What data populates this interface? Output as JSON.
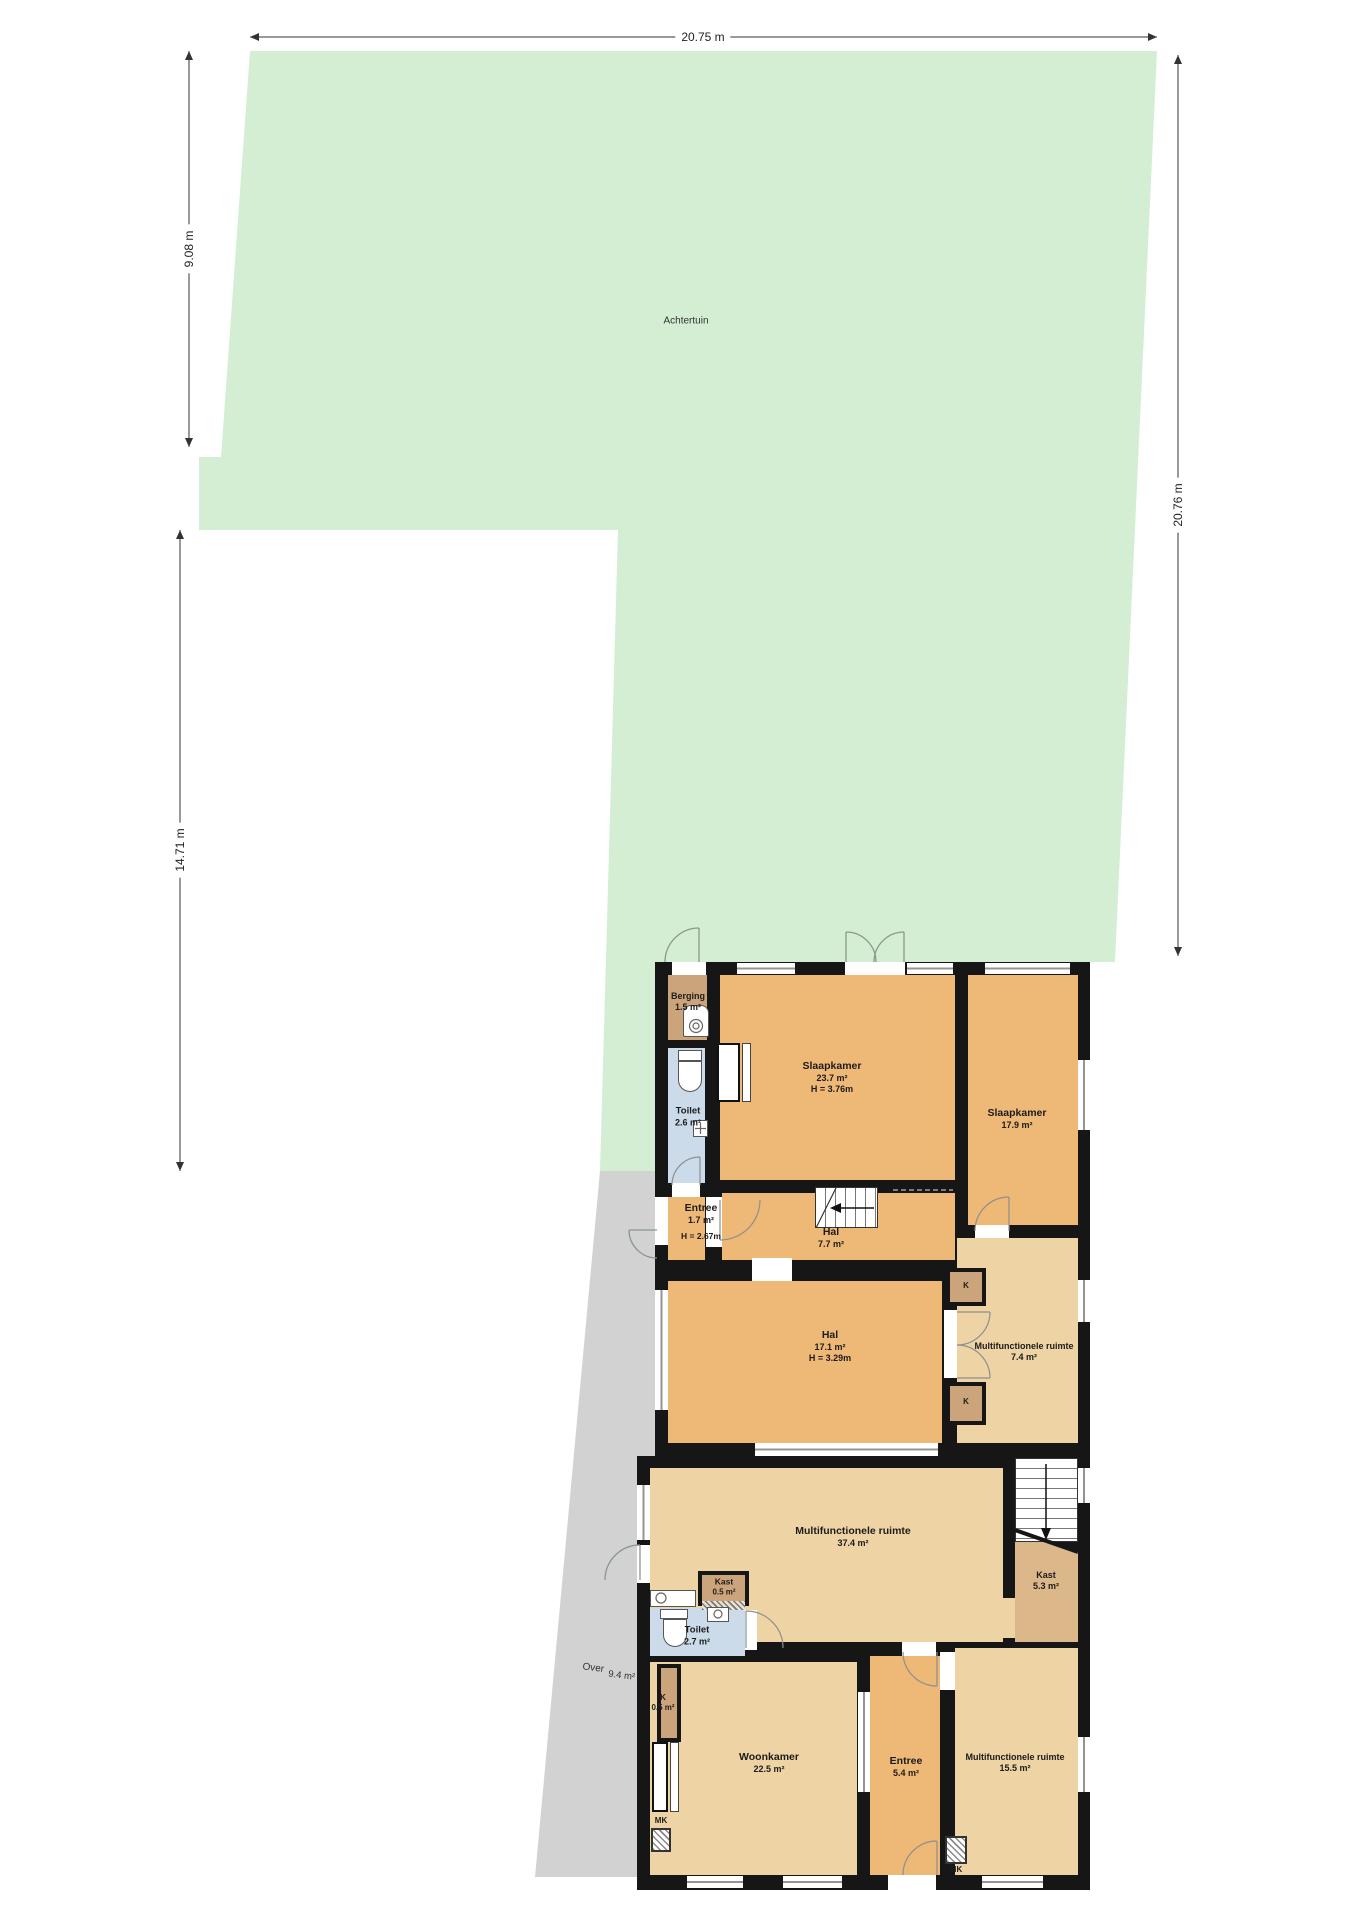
{
  "dimensions": {
    "top": "20.75 m",
    "left_upper": "9.08 m",
    "left_lower": "14.71 m",
    "right": "20.76 m"
  },
  "areas": {
    "garden": {
      "name": "Achtertuin"
    },
    "over": {
      "name": "Over",
      "area": "9.4 m²"
    }
  },
  "rooms": {
    "berging": {
      "name": "Berging",
      "area": "1.5 m²"
    },
    "toilet_boven": {
      "name": "Toilet",
      "area": "2.6 m²"
    },
    "slaapkamer_groot": {
      "name": "Slaapkamer",
      "area": "23.7 m²",
      "height": "H = 3.76m"
    },
    "slaapkamer_klein": {
      "name": "Slaapkamer",
      "area": "17.9 m²"
    },
    "entree_boven": {
      "name": "Entree",
      "area": "1.7 m²",
      "height": "H = 2.67m"
    },
    "hal_boven": {
      "name": "Hal",
      "area": "7.7 m²"
    },
    "hal_midden": {
      "name": "Hal",
      "area": "17.1 m²",
      "height": "H = 3.29m"
    },
    "multifunctioneel_klein": {
      "name": "Multifunctionele ruimte",
      "area": "7.4 m²"
    },
    "multifunctioneel_groot": {
      "name": "Multifunctionele ruimte",
      "area": "37.4 m²"
    },
    "kast_trap": {
      "name": "Kast",
      "area": "5.3 m²"
    },
    "kast_klein": {
      "name": "Kast",
      "area": "0.5 m²"
    },
    "toilet_beneden": {
      "name": "Toilet",
      "area": "2.7 m²"
    },
    "k_kast": {
      "name": "K",
      "area": "0.5 m²"
    },
    "woonkamer": {
      "name": "Woonkamer",
      "area": "22.5 m²"
    },
    "entree_beneden": {
      "name": "Entree",
      "area": "5.4 m²"
    },
    "multifunctioneel_voor": {
      "name": "Multifunctionele ruimte",
      "area": "15.5 m²"
    },
    "k1": {
      "name": "K"
    },
    "k2": {
      "name": "K"
    },
    "mk1": {
      "name": "MK"
    },
    "mk2": {
      "name": "MK"
    }
  },
  "colors": {
    "garden_green": "#d3eed3",
    "paving_gray": "#d2d2d2",
    "wall_black": "#161616",
    "room_orange": "#eeb877",
    "room_tan": "#eed3a4",
    "closet_brown": "#cba47c",
    "wet_room_blue": "#ccdbe9",
    "understairs_tan": "#dbb78a"
  }
}
